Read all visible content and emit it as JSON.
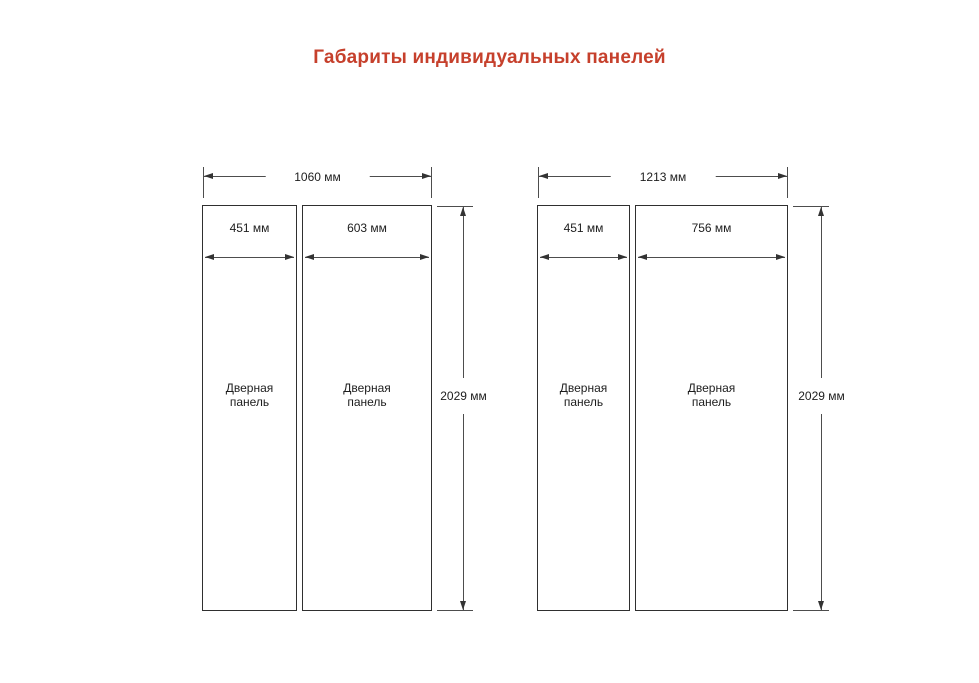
{
  "page": {
    "title": "Габариты индивидуальных панелей",
    "background": "#ffffff"
  },
  "colors": {
    "title": "#c6402c",
    "dimension_line": "#4d4d4d",
    "panel_border": "#2f2f2f",
    "label_text": "#1d1d1d"
  },
  "icons": {
    "arrow_left": "css-triangle-left",
    "arrow_right": "css-triangle-right",
    "arrow_up": "css-triangle-up",
    "arrow_down": "css-triangle-down"
  },
  "units": "мм",
  "diagrams": [
    {
      "total_width_mm": 1060,
      "total_width_label": "1060 мм",
      "height_mm": 2029,
      "height_label": "2029 мм",
      "panels": [
        {
          "name": "Дверная панель",
          "width_mm": 451,
          "width_label": "451 мм"
        },
        {
          "name": "Дверная панель",
          "width_mm": 603,
          "width_label": "603 мм"
        }
      ]
    },
    {
      "total_width_mm": 1213,
      "total_width_label": "1213 мм",
      "height_mm": 2029,
      "height_label": "2029 мм",
      "panels": [
        {
          "name": "Дверная панель",
          "width_mm": 451,
          "width_label": "451 мм"
        },
        {
          "name": "Дверная панель",
          "width_mm": 756,
          "width_label": "756 мм"
        }
      ]
    }
  ]
}
